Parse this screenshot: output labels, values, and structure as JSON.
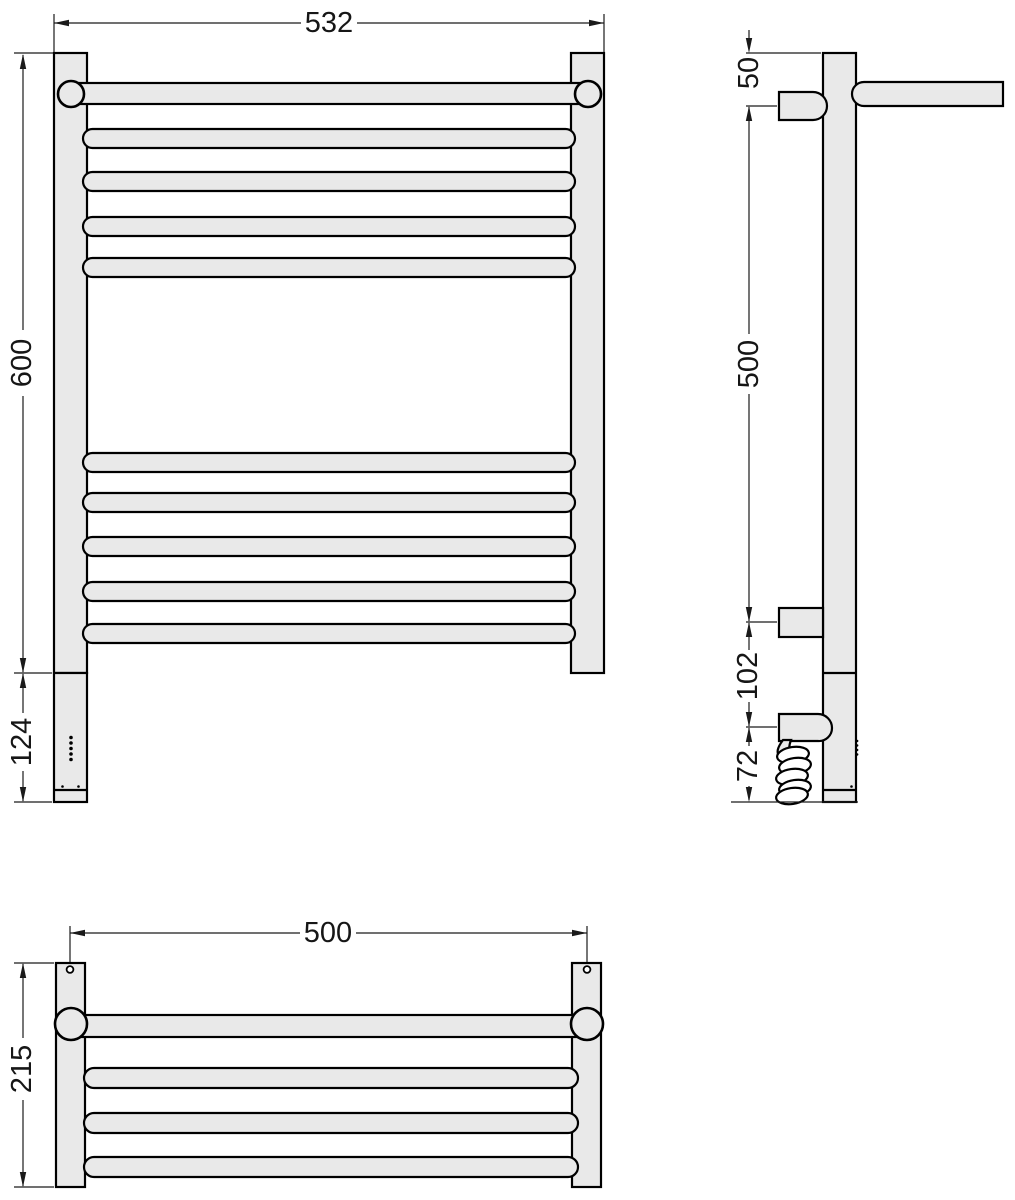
{
  "title": "towel-rail-technical-drawing",
  "colors": {
    "background": "#ffffff",
    "body_fill": "#e9e9e9",
    "outline": "#000000",
    "dimension_line": "#1a1a1a"
  },
  "views": {
    "front": {
      "dimensions": {
        "overall_width": "532",
        "overall_height": "600",
        "control_unit_height": "124"
      }
    },
    "side": {
      "dimensions": {
        "top_to_upper_bracket": "50",
        "upper_to_lower_bracket": "500",
        "lower_bracket_to_cable_entry": "102",
        "cable_entry_to_bottom": "72"
      }
    },
    "top": {
      "dimensions": {
        "mounting_hole_spacing": "500",
        "overall_depth": "215"
      }
    }
  }
}
